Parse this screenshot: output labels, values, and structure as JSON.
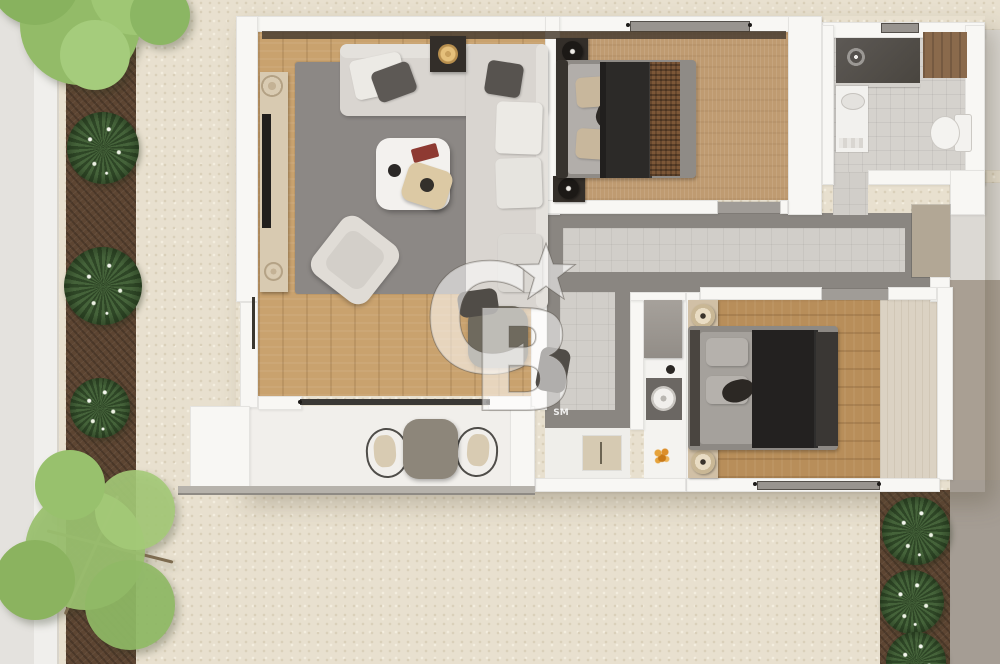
{
  "watermark": {
    "letter_c": "C",
    "letter_b": "B",
    "service_mark": "SM"
  },
  "palette": {
    "ground_gravel": "#e8e0cf",
    "sidewalk": "#eceae6",
    "planting_soil": "#5d4532",
    "tree_foliage": "#93bb68",
    "bush_foliage": "#3a5630",
    "wall_white": "#f8f7f4",
    "wood_living": "#c9a26e",
    "carpet_bedroom1": "#bf9b71",
    "wood_bedroom2": "#b88e5a",
    "pale_wood": "#dbd2c3",
    "rug_gray": "#8c8885",
    "hall_tile_dark": "#8a8681",
    "hall_tile_light": "#d1cec9",
    "sofa_gray": "#d9d5d0",
    "bed_blanket_dark": "#2c2a28",
    "bed_throw_brown": "#7c5737",
    "shower_dark": "#56524e",
    "counter_dark": "#6b6763",
    "accent_gold": "#e5c07b",
    "accent_orange": "#dd8f2a",
    "neighbor_taupe": "#a99f93",
    "watermark_fill": "rgba(255,255,255,0.55)"
  },
  "scene": {
    "rooms": [
      "living-room",
      "bedroom-1",
      "bathroom",
      "hallway",
      "kitchen",
      "bedroom-2",
      "entry",
      "balcony"
    ],
    "outdoor": [
      "sidewalk",
      "planting-strip-left",
      "planting-strip-bottom-right",
      "gravel-ground",
      "trees",
      "bushes"
    ]
  }
}
